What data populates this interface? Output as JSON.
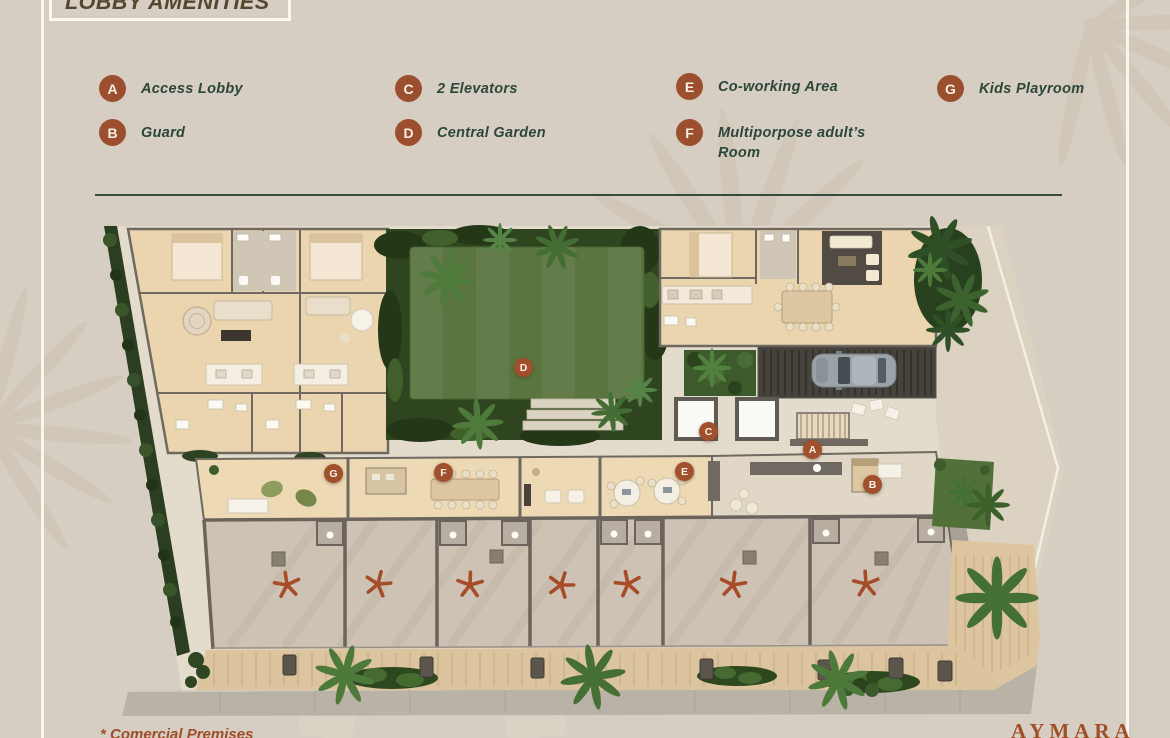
{
  "header": {
    "title": "LOBBY AMENITIES"
  },
  "legend": {
    "items": [
      {
        "letter": "A",
        "label": "Access Lobby"
      },
      {
        "letter": "B",
        "label": "Guard"
      },
      {
        "letter": "C",
        "label": "2 Elevators"
      },
      {
        "letter": "D",
        "label": "Central Garden"
      },
      {
        "letter": "E",
        "label": "Co-working Area"
      },
      {
        "letter": "F",
        "label": "Multiporpose adult’s Room"
      },
      {
        "letter": "G",
        "label": "Kids Playroom"
      }
    ]
  },
  "plan": {
    "markers": [
      {
        "letter": "A"
      },
      {
        "letter": "B"
      },
      {
        "letter": "C"
      },
      {
        "letter": "D"
      },
      {
        "letter": "E"
      },
      {
        "letter": "F"
      },
      {
        "letter": "G"
      }
    ],
    "asterisk_count": 7
  },
  "footer": {
    "note": "* Comercial Premises",
    "brand": "AYMARA"
  },
  "colors": {
    "background": "#d6cec2",
    "marker": "#9c4f2e",
    "legend_text": "#2d463a",
    "divider": "#39493f",
    "brand_text": "#a04e28",
    "garden_green": "#5b7540",
    "wood_floor": "#ebd5af"
  }
}
